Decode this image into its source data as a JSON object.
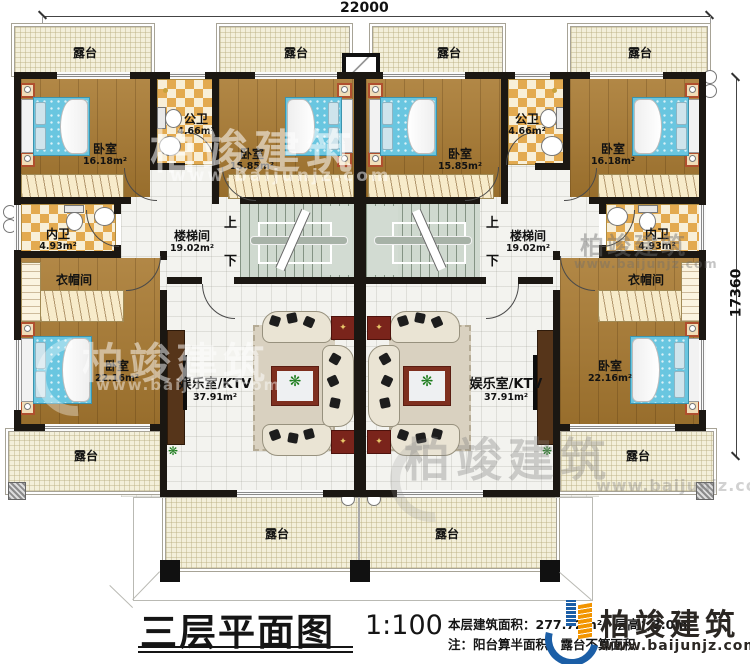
{
  "dimensions": {
    "width_mm": "22000",
    "height_mm": "17360"
  },
  "stairs": {
    "up": "上",
    "down": "下"
  },
  "rooms": {
    "terrace": "露台",
    "bedroom_a": {
      "name": "卧室",
      "area": "16.18m²"
    },
    "bedroom_b": {
      "name": "卧室",
      "area": "15.85m²"
    },
    "bedroom_c": {
      "name": "卧室",
      "area": "22.16m²"
    },
    "public_bath": {
      "name": "公卫",
      "area": "4.66m²"
    },
    "ensuite_bath": {
      "name": "内卫",
      "area": "4.93m²"
    },
    "cloakroom": {
      "name": "衣帽间"
    },
    "stairwell": {
      "name": "楼梯间",
      "area": "19.02m²"
    },
    "ktv": {
      "name": "娱乐室/KTV",
      "area": "37.91m²"
    }
  },
  "title_block": {
    "title": "三层平面图",
    "scale": "1:100",
    "area_line": "本层建筑面积：277.72m²　层高：3.0m",
    "note": "注：阳台算半面积，露台不算面积",
    "brand": "柏竣建筑",
    "website": "www.baijunjz.com"
  },
  "watermark": {
    "brand": "柏竣建筑",
    "website": "www.baijunjz.com"
  },
  "icons": {
    "plant": "❋",
    "star": "✦"
  }
}
